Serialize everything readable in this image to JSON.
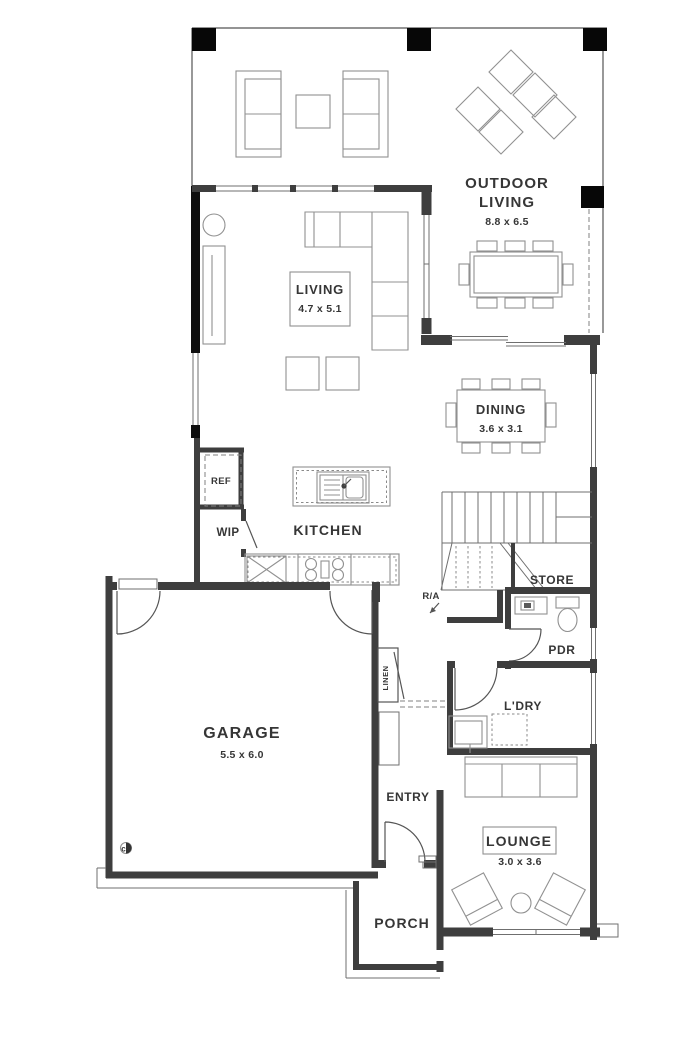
{
  "colors": {
    "wall": "#3e3e3e",
    "feature_wall": "#0e0e0e",
    "furniture_line": "#919191",
    "thin_line": "#6f6f6f",
    "text": "#363636",
    "background": "#ffffff"
  },
  "rooms": {
    "outdoor_living": {
      "line1": "OUTDOOR",
      "line2": "LIVING",
      "dims": "8.8 x 6.5"
    },
    "living": {
      "name": "LIVING",
      "dims": "4.7 x 5.1"
    },
    "dining": {
      "name": "DINING",
      "dims": "3.6 x 3.1"
    },
    "kitchen": {
      "name": "KITCHEN"
    },
    "ref": {
      "name": "REF"
    },
    "wip": {
      "name": "WIP"
    },
    "store": {
      "name": "STORE"
    },
    "return_air": {
      "name": "R/A"
    },
    "pdr": {
      "name": "PDR"
    },
    "laundry": {
      "name": "L'DRY"
    },
    "linen": {
      "name": "LINEN"
    },
    "garage": {
      "name": "GARAGE",
      "dims": "5.5 x 6.0"
    },
    "entry": {
      "name": "ENTRY"
    },
    "lounge": {
      "name": "LOUNGE",
      "dims": "3.0 x 3.6"
    },
    "porch": {
      "name": "PORCH"
    },
    "meter": {
      "label": "c"
    }
  }
}
